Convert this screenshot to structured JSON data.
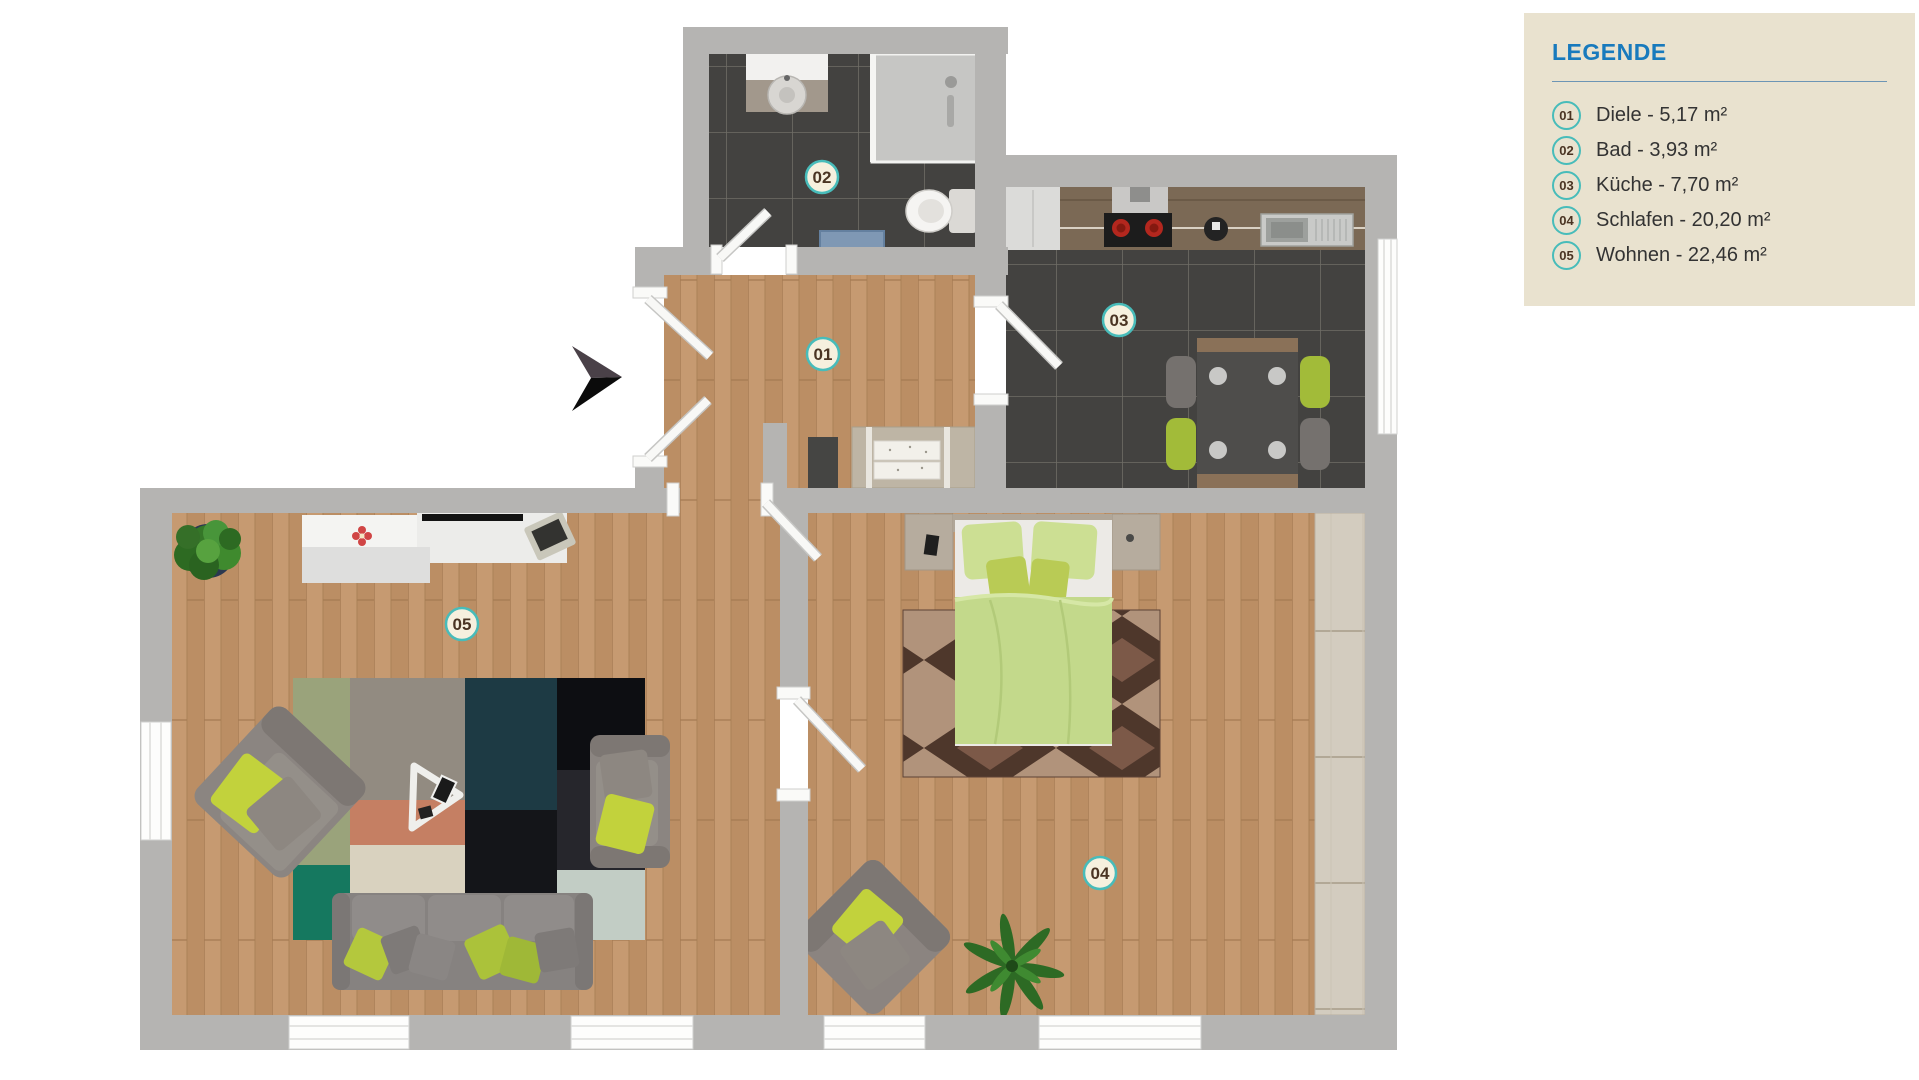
{
  "legend": {
    "title": "LEGENDE",
    "items": [
      {
        "number": "01",
        "name": "Diele",
        "area": "5,17 m²",
        "label": "Diele - 5,17 m²"
      },
      {
        "number": "02",
        "name": "Bad",
        "area": "3,93 m²",
        "label": "Bad - 3,93 m²"
      },
      {
        "number": "03",
        "name": "Küche",
        "area": "7,70 m²",
        "label": "Küche - 7,70 m²"
      },
      {
        "number": "04",
        "name": "Schlafen",
        "area": "20,20 m²",
        "label": "Schlafen - 20,20 m²"
      },
      {
        "number": "05",
        "name": "Wohnen",
        "area": "22,46 m²",
        "label": "Wohnen - 22,46 m²"
      }
    ]
  },
  "theme": {
    "page_bg": "#ffffff",
    "wall": "#b5b4b2",
    "legend_bg": "#e9e2cf",
    "legend_title": "#187abd",
    "legend_text": "#333333",
    "badge_ring": "#48bcba",
    "badge_fill": "#f6f0de",
    "badge_text": "#4a3423",
    "accent_green": "#b5c93e"
  }
}
